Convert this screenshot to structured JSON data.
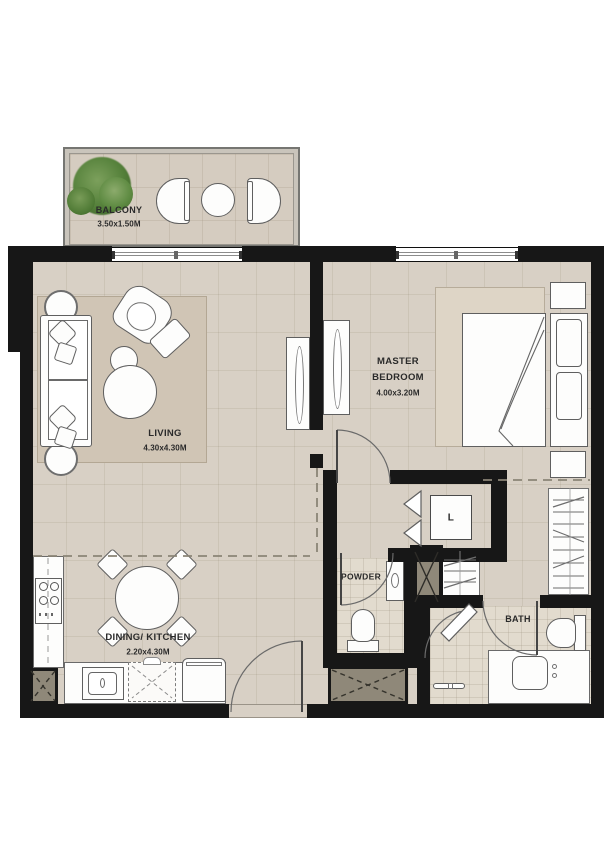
{
  "plan_title": "apartment-floor-plan",
  "rooms": [
    {
      "id": "balcony",
      "label": "BALCONY",
      "dimensions": "3.50x1.50M"
    },
    {
      "id": "living",
      "label": "LIVING",
      "dimensions": "4.30x4.30M"
    },
    {
      "id": "master-bedroom",
      "line1": "MASTER",
      "line2": "BEDROOM",
      "dimensions": "4.00x3.20M"
    },
    {
      "id": "dining-kitchen",
      "label": "DINING/ KITCHEN",
      "dimensions": "2.20x4.30M"
    },
    {
      "id": "powder",
      "label": "POWDER"
    },
    {
      "id": "bath",
      "label": "BATH"
    },
    {
      "id": "laundry",
      "label": "L"
    }
  ],
  "colors": {
    "wall": "#171717",
    "floor": "#d8d0c5",
    "wet_floor": "#e2dbce",
    "living_rug": "#d0c5b5",
    "bedroom_rug": "#ded5c6",
    "balcony_floor": "#d5ccc0",
    "shaft": "#8f8879",
    "plant_green": "#54803a",
    "fixture_line": "#5f5f5f"
  },
  "legend_icons": [
    "plant-icon",
    "balcony-chair-icon",
    "balcony-table-icon",
    "sofa-icon",
    "armchair-icon",
    "ottoman-icon",
    "coffee-table-icon",
    "side-table-icon",
    "tv-console-icon",
    "bed-icon",
    "nightstand-icon",
    "wardrobe-icon",
    "linen-shelf-icon",
    "washer-icon",
    "toilet-icon",
    "washbasin-icon",
    "vanity-icon",
    "shower-icon",
    "dining-table-icon",
    "dining-chair-icon",
    "stove-icon",
    "kitchen-sink-icon",
    "dishwasher-icon",
    "refrigerator-icon",
    "shaft-icon",
    "door-swing-icon",
    "window-icon"
  ]
}
